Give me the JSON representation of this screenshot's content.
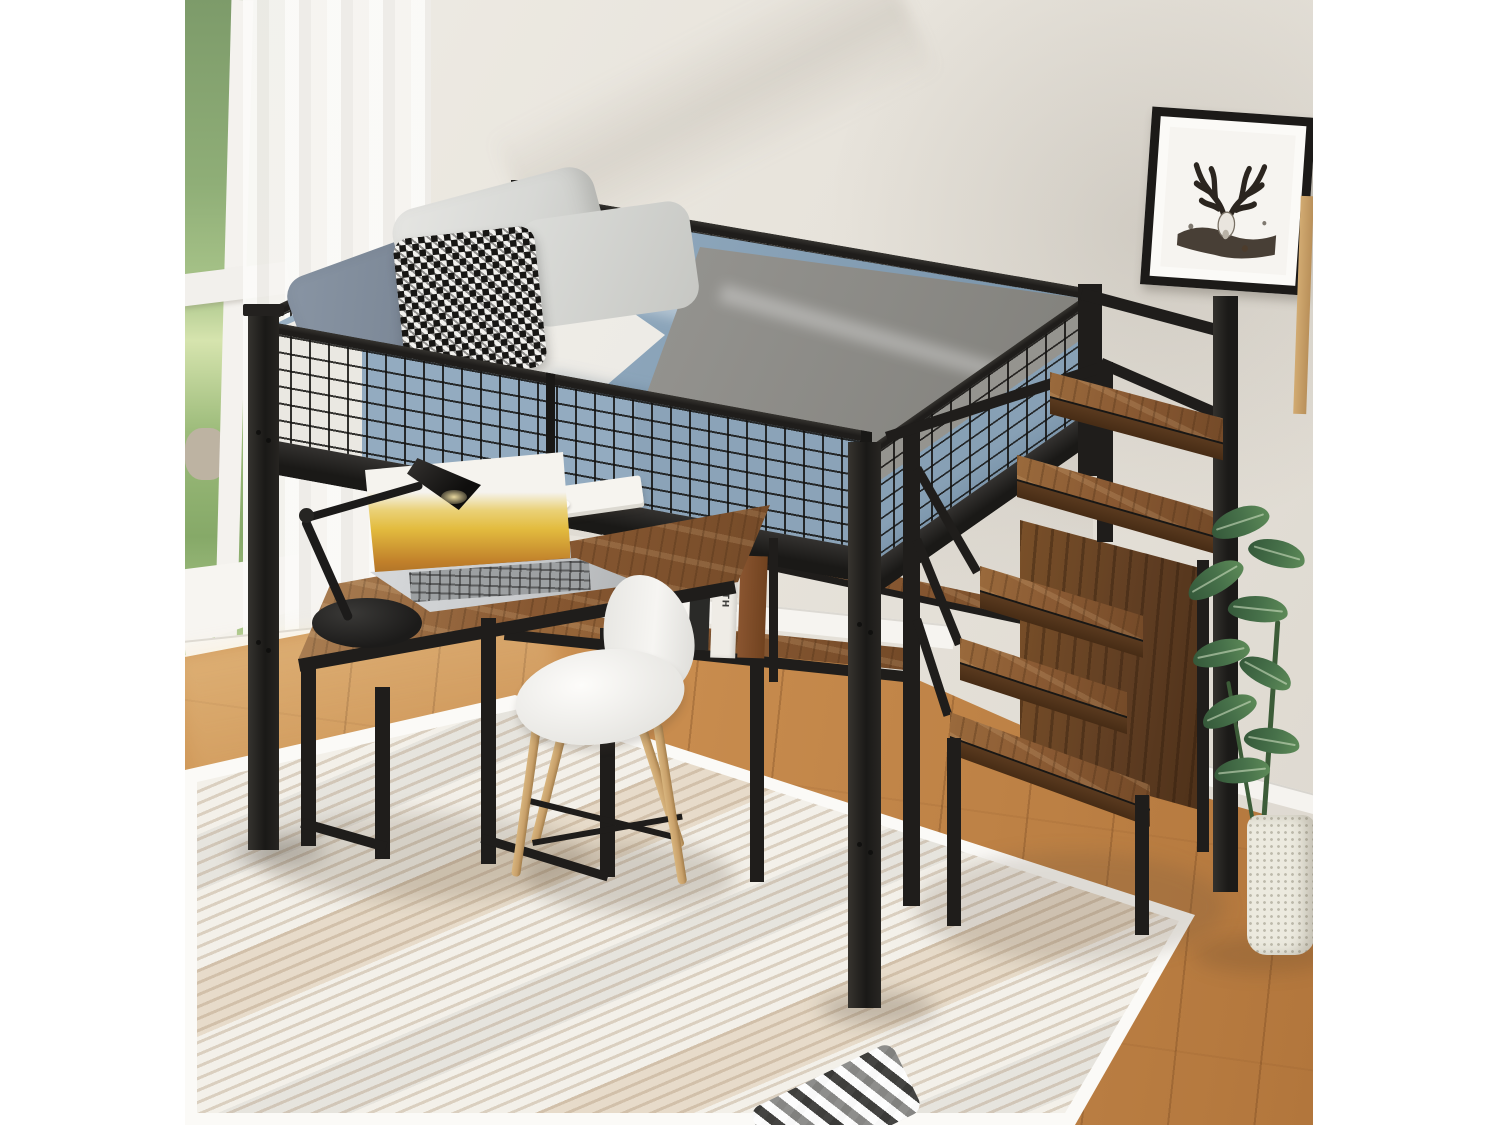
{
  "image": {
    "type": "furniture-product-photograph",
    "subject": "Black metal full loft bed with mesh guardrails, built-in L-shaped rustic wood desk, storage staircase shelves, shown in a bright bedroom",
    "width_px": 1500,
    "height_px": 1125
  },
  "palette": {
    "margin": "#ffffff",
    "wall": "#e7e3db",
    "wall-shadow": "#c9c4ba",
    "metal": "#1f1d1b",
    "metal-dark": "#151412",
    "wood-rustic": "#8a5a33",
    "wood-rustic-dark": "#5f3d22",
    "floor": "#c88c4e",
    "floor-dark": "#b2763c",
    "rug": "#f3f0e9",
    "rug-border": "#fbfaf7",
    "rug-stripe": "#b38a5e",
    "curtain": "#f7f5f1",
    "greenery": "#8fae77",
    "grass": "#a9c487",
    "bedding-blue": "#8ca5ba",
    "bedding-blue-dark": "#7c96ac",
    "blanket-gray": "#92918d",
    "mattress-white": "#eceae5",
    "pillow-light": "#d7d8d5",
    "pillow-blue-gray": "#7e8a99",
    "houndstooth-dark": "#171614",
    "chair-white": "#f6f5f2",
    "chair-leg-wood": "#c8a06a",
    "book-teal": "#5fae9f",
    "book-teal-dark": "#4c9488",
    "cup-silver": "#a9acae",
    "laptop-body": "#c9cbcd",
    "laptop-screen-yellow": "#e3bc3f",
    "lamp-black": "#1c1b1a",
    "plant-green": "#47714a",
    "plant-green-dark": "#35593a",
    "basket-white": "#eceadf",
    "frame-black": "#1c1a18",
    "art-ink": "#2b251f",
    "plaid-gray": "#8a8a88"
  },
  "scene": {
    "window": {
      "label": "tall window with white frame and green garden view"
    },
    "curtain": {
      "label": "sheer white curtain"
    },
    "wall_art": {
      "label": "black framed deer antler skull art print"
    },
    "side_frame": {
      "label": "edge of wooden picture frame at right"
    },
    "loft_bed": {
      "label": "black metal loft bed with wire-mesh guardrails",
      "bedding": {
        "comforter": "light blue comforter",
        "blanket": "gray knit blanket",
        "pillows": [
          "gray-blue pillow",
          "two light gray pillows",
          "black and white houndstooth accent pillow"
        ]
      }
    },
    "desk": {
      "label": "L-shaped rustic brown wood desk with black metal frame under loft",
      "items": [
        "silver laptop with mountain wallpaper",
        "black swing-arm desk lamp",
        "white coffee cup on saucer atop white book",
        "teal book stack with steel tumbler",
        "hourglass with white sand",
        "standing books on hutch shelf"
      ],
      "shelf_books": {
        "spine_text": "MACBETH"
      }
    },
    "chair": {
      "label": "white shell desk chair with splayed wooden legs"
    },
    "staircase": {
      "label": "rustic wood storage staircase with black frame and handrail",
      "steps": 5
    },
    "plant": {
      "label": "green potted plant in white woven basket"
    },
    "rug": {
      "label": "cream striped area rug"
    },
    "floor": {
      "label": "warm oak wood floor"
    },
    "throw_pillow": {
      "label": "gray plaid throw pillow on rug"
    }
  }
}
